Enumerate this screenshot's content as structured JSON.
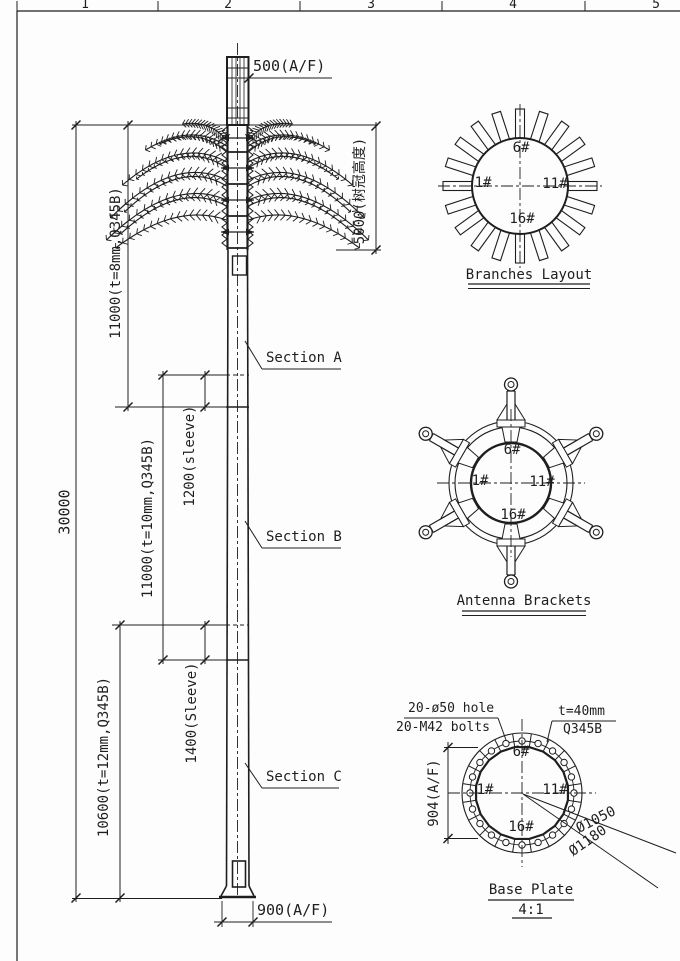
{
  "colors": {
    "ink": "#1e1e1e",
    "bg": "#fdfdfd"
  },
  "ruler": {
    "numbers": [
      "1",
      "2",
      "3",
      "4",
      "5"
    ]
  },
  "elevation": {
    "labels": {
      "top_af": "500(A/F)",
      "crown_height": "5000(树冠高度)",
      "segment_a": "11000(t=8mm,Q345B)",
      "section_a": "Section A",
      "sleeve_1": "1200(sleeve)",
      "overall_height": "30000",
      "segment_b": "11000(t=10mm,Q345B)",
      "section_b": "Section B",
      "sleeve_2": "1400(Sleeve)",
      "segment_c": "10600(t=12mm,Q345B)",
      "section_c": "Section C",
      "base_af": "900(A/F)"
    }
  },
  "branches_layout": {
    "title": "Branches Layout",
    "branch_count": 20,
    "labels": {
      "top": "6#",
      "left": "1#",
      "right": "11#",
      "bottom": "16#"
    }
  },
  "antenna_brackets": {
    "title": "Antenna Brackets",
    "bracket_count": 6,
    "labels": {
      "top": "6#",
      "left": "1#",
      "right": "11#",
      "bottom": "16#"
    }
  },
  "base_plate": {
    "title": "Base Plate",
    "scale": "4:1",
    "hole_count": 20,
    "notes": {
      "holes": "20-ø50 hole",
      "bolts": "20-M42 bolts",
      "thickness": "t=40mm",
      "material": "Q345B"
    },
    "dims": {
      "af": "904(A/F)",
      "bolt_circle": "Ø1050",
      "outer": "Ø1180"
    },
    "labels": {
      "top": "6#",
      "left": "1#",
      "right": "11#",
      "bottom": "16#"
    }
  }
}
